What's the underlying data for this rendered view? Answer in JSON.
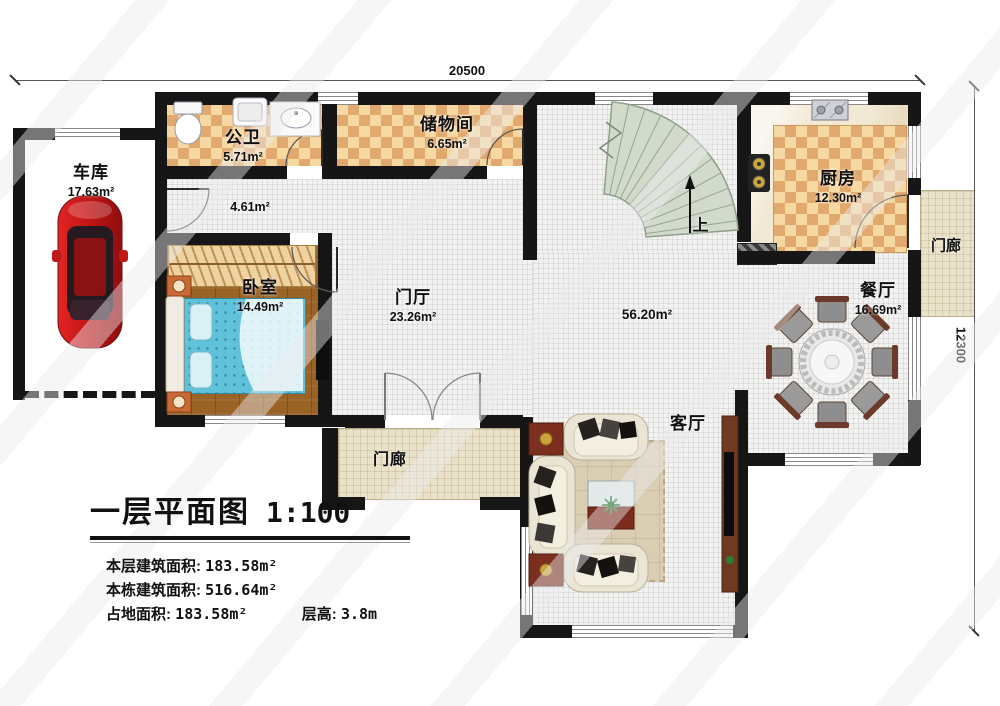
{
  "dimensions": {
    "top": "20500",
    "right": "12300"
  },
  "rooms": {
    "garage": {
      "name": "车库",
      "area": "17.63m²"
    },
    "bathroom": {
      "name": "公卫",
      "area": "5.71m²"
    },
    "storage": {
      "name": "储物间",
      "area": "6.65m²"
    },
    "kitchen": {
      "name": "厨房",
      "area": "12.30m²"
    },
    "bedroom": {
      "name": "卧室",
      "area": "14.49m²"
    },
    "foyer": {
      "name": "门厅",
      "area": "23.26m²"
    },
    "corridor": {
      "area": "4.61m²"
    },
    "hall": {
      "name": "客厅",
      "area": "56.20m²"
    },
    "dining": {
      "name": "餐厅",
      "area": "16.69m²"
    },
    "porch_bottom": {
      "name": "门廊"
    },
    "porch_right": {
      "name": "门廊"
    }
  },
  "stairs": {
    "up_label": "上"
  },
  "legend": {
    "title": "一层平面图",
    "scale": "1:100",
    "rows": [
      {
        "label": "本层建筑面积:",
        "value": "183.58m²"
      },
      {
        "label": "本栋建筑面积:",
        "value": "516.64m²"
      },
      {
        "label": "占地面积:",
        "value": "183.58m²",
        "label2": "层高:",
        "value2": "3.8m"
      }
    ]
  }
}
